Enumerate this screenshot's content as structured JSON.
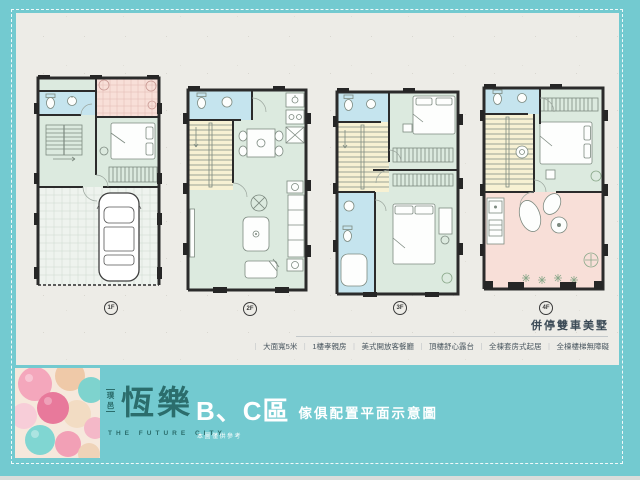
{
  "palette": {
    "background_teal": "#73CAD0",
    "paper": "#EDECE7",
    "wall_dark": "#2B2B2B",
    "room_green": "#DCEADF",
    "room_blue": "#C5E4EE",
    "room_yellow": "#F7F1D3",
    "room_pink": "#F8DFD8",
    "brand_teal": "#2B6D6C",
    "headline_dark": "#3C4B57",
    "text_gray": "#49565F",
    "white": "#FFFFFF"
  },
  "plans": {
    "labels": [
      "1F",
      "2F",
      "3F",
      "4F"
    ]
  },
  "headline": {
    "tagline": "併停雙車美墅"
  },
  "features": {
    "separator": "｜",
    "items": [
      "大面寬5米",
      "1樓孝親房",
      "美式開放客餐廳",
      "頂樓舒心露台",
      "全棟套房式起居",
      "全棟樓梯無障礙"
    ]
  },
  "brand": {
    "prefix_top": "璞",
    "prefix_bottom": "邑",
    "name": "恆樂",
    "tagline_en": "THE FUTURE CITY",
    "zone": "B、C區",
    "zone_desc": "傢俱配置平面示意圖",
    "disclaimer": "本圖僅供參考"
  }
}
